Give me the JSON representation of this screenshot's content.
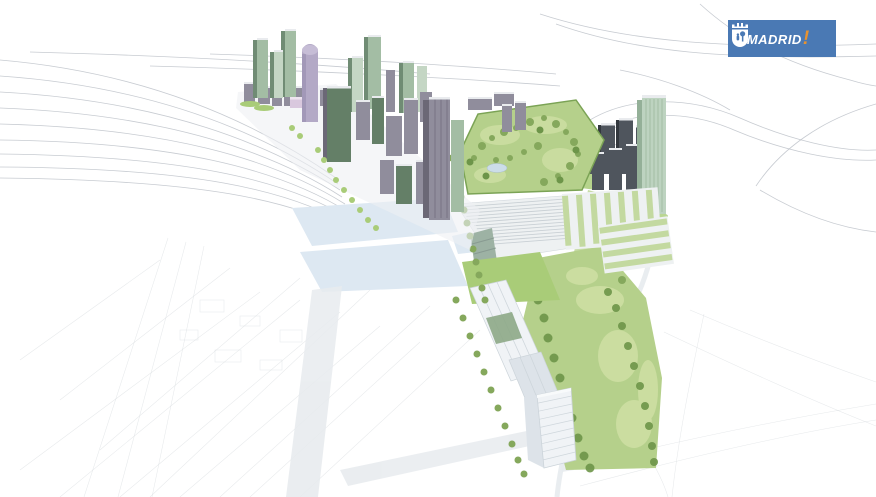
{
  "window": {
    "width": 876,
    "height": 497,
    "background": "#ffffff"
  },
  "logo": {
    "alt": "Ayuntamiento de Madrid",
    "open_exclamation": "¡",
    "wordmark": "MADRID",
    "close_exclamation": "!",
    "colors": {
      "background": "#4a79b4",
      "wordmark": "#ffffff",
      "exclamation": "#e8922e",
      "crest": "#ffffff"
    }
  },
  "illustration": {
    "type": "architectural-aerial-rendering",
    "subject": "masterplan-bird-eye-view",
    "colors": {
      "wireframe": "#b9bec6",
      "wireframeFaint": "#d6dade",
      "plazaBlue": "#dde8f2",
      "roadGray": "#e7ebee",
      "parkGreen": "#b5d08b",
      "parkLight": "#cfe0a4",
      "lawnGreen": "#a9cc78",
      "treeGreen": "#85a85c",
      "treeDark": "#6d9549",
      "hedgeGreen": "#7ba355",
      "pondBlue": "#ccdde9",
      "towerGreen": "#a3bda4",
      "towerGreenDark": "#708c74",
      "towerPale": "#c4d6c4",
      "cylinderPurple": "#b3a9c6",
      "cylinderCap": "#c6bdd6",
      "cylinderShade": "#9d93b4",
      "pinkSlab": "#d9c8de",
      "blockGray": "#908d9c",
      "blockGrayDark": "#6b6876",
      "blockGreen": "#647f67",
      "darkTower": "#4f555d",
      "darkTowerSide": "#33383e",
      "blockTop": "#e9ebee",
      "glassGreen": "#bdd3c0",
      "glassStripe": "#94b098",
      "canopyWhite": "#eef1f2",
      "canopyLine": "#c6cdd2",
      "wedgeGreen": "#9db2a4",
      "louverGreen": "#84958d",
      "slabWhite": "#f0f3f6",
      "slabShade": "#dde3e9",
      "slabLine": "#ccd4da",
      "roofGreenDark": "#8da887",
      "greenRoof": "#c3d9a0",
      "groundWash": "#eef0f3"
    }
  }
}
